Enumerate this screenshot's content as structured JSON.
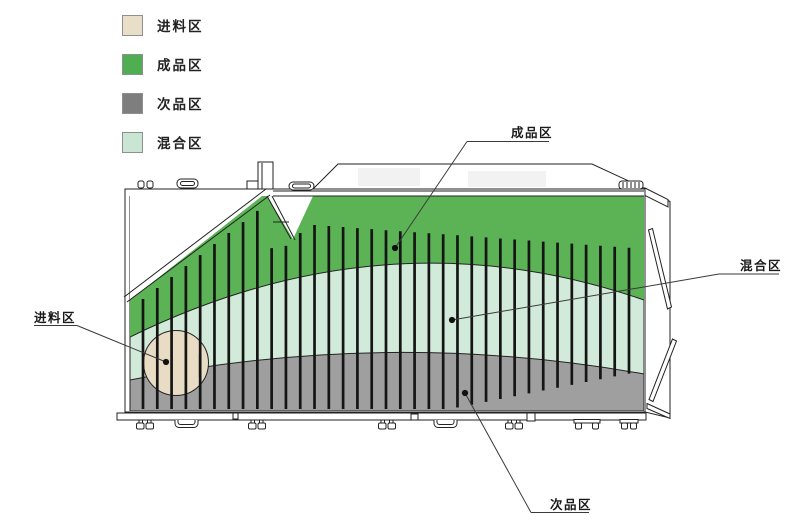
{
  "legend": {
    "items": [
      {
        "id": "feed",
        "label": "进料区",
        "color": "#e9dec7"
      },
      {
        "id": "finished",
        "label": "成品区",
        "color": "#4fae52"
      },
      {
        "id": "reject",
        "label": "次品区",
        "color": "#7e7e7e"
      },
      {
        "id": "mixed",
        "label": "混合区",
        "color": "#c9e6d4"
      }
    ]
  },
  "annotations": [
    {
      "id": "feed",
      "label": "进料区"
    },
    {
      "id": "finished",
      "label": "成品区"
    },
    {
      "id": "mixed",
      "label": "混合区"
    },
    {
      "id": "reject",
      "label": "次品区"
    }
  ],
  "colors": {
    "green": "#5bb355",
    "mint": "#d2ead9",
    "gray": "#9f9f9f",
    "beige": "#e8dcc4",
    "outline": "#222222"
  }
}
